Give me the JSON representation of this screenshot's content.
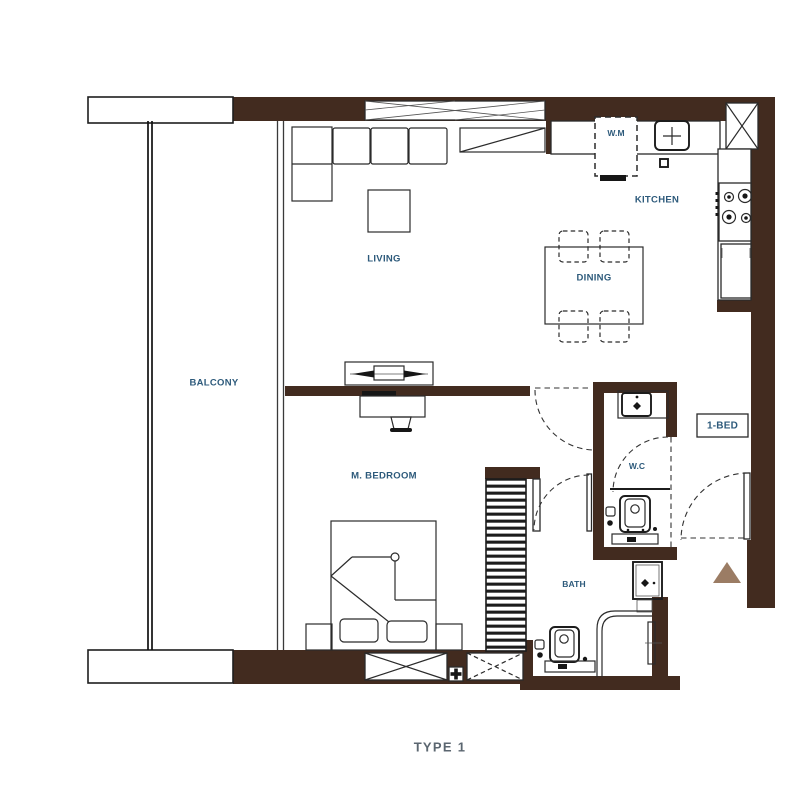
{
  "plan": {
    "title": "TYPE 1",
    "unit_badge": "1-BED",
    "rooms": {
      "balcony": "BALCONY",
      "living": "LIVING",
      "kitchen": "KITCHEN",
      "dining": "DINING",
      "bedroom": "M. BEDROOM",
      "wc": "W.C",
      "bath": "BATH"
    },
    "appliances": {
      "washing_machine": "W.M"
    },
    "colors": {
      "wall": "#422B1F",
      "room_label": "#2D5A7B",
      "title_label": "#5B6670",
      "entry_marker": "#9B7C64"
    }
  }
}
